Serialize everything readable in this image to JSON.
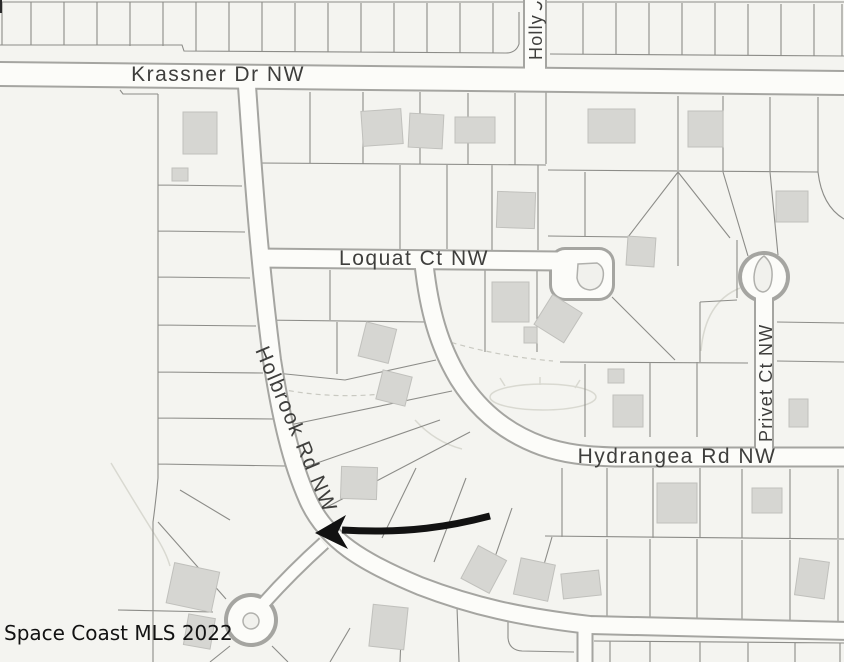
{
  "map": {
    "attribution": "Space Coast MLS 2022",
    "streets": [
      {
        "label": "Krassner Dr NW",
        "orientation": "horizontal"
      },
      {
        "label": "Holly",
        "orientation": "vertical"
      },
      {
        "label": "Loquat Ct NW",
        "orientation": "horizontal"
      },
      {
        "label": "Holbrook Rd NW",
        "orientation": "diagonal"
      },
      {
        "label": "Hydrangea Rd NW",
        "orientation": "horizontal"
      },
      {
        "label": "Privet Ct NW",
        "orientation": "vertical"
      }
    ],
    "annotation_arrow": {
      "color": "#121212",
      "points_to": "Holbrook Rd NW"
    },
    "colors": {
      "background": "#f4f4f0",
      "road_fill": "#fcfcf9",
      "road_casing": "#a5a5a1",
      "parcel_line": "#8c8c88",
      "building_fill": "#d6d6d2",
      "building_stroke": "#c0c0bc",
      "island_fill": "#f1f1ed",
      "island_stroke": "#b0b0ac",
      "faint_line": "#d9d9d1",
      "label_text": "#3e3e3c",
      "arrow": "#121212",
      "watermark": "#121212"
    }
  }
}
